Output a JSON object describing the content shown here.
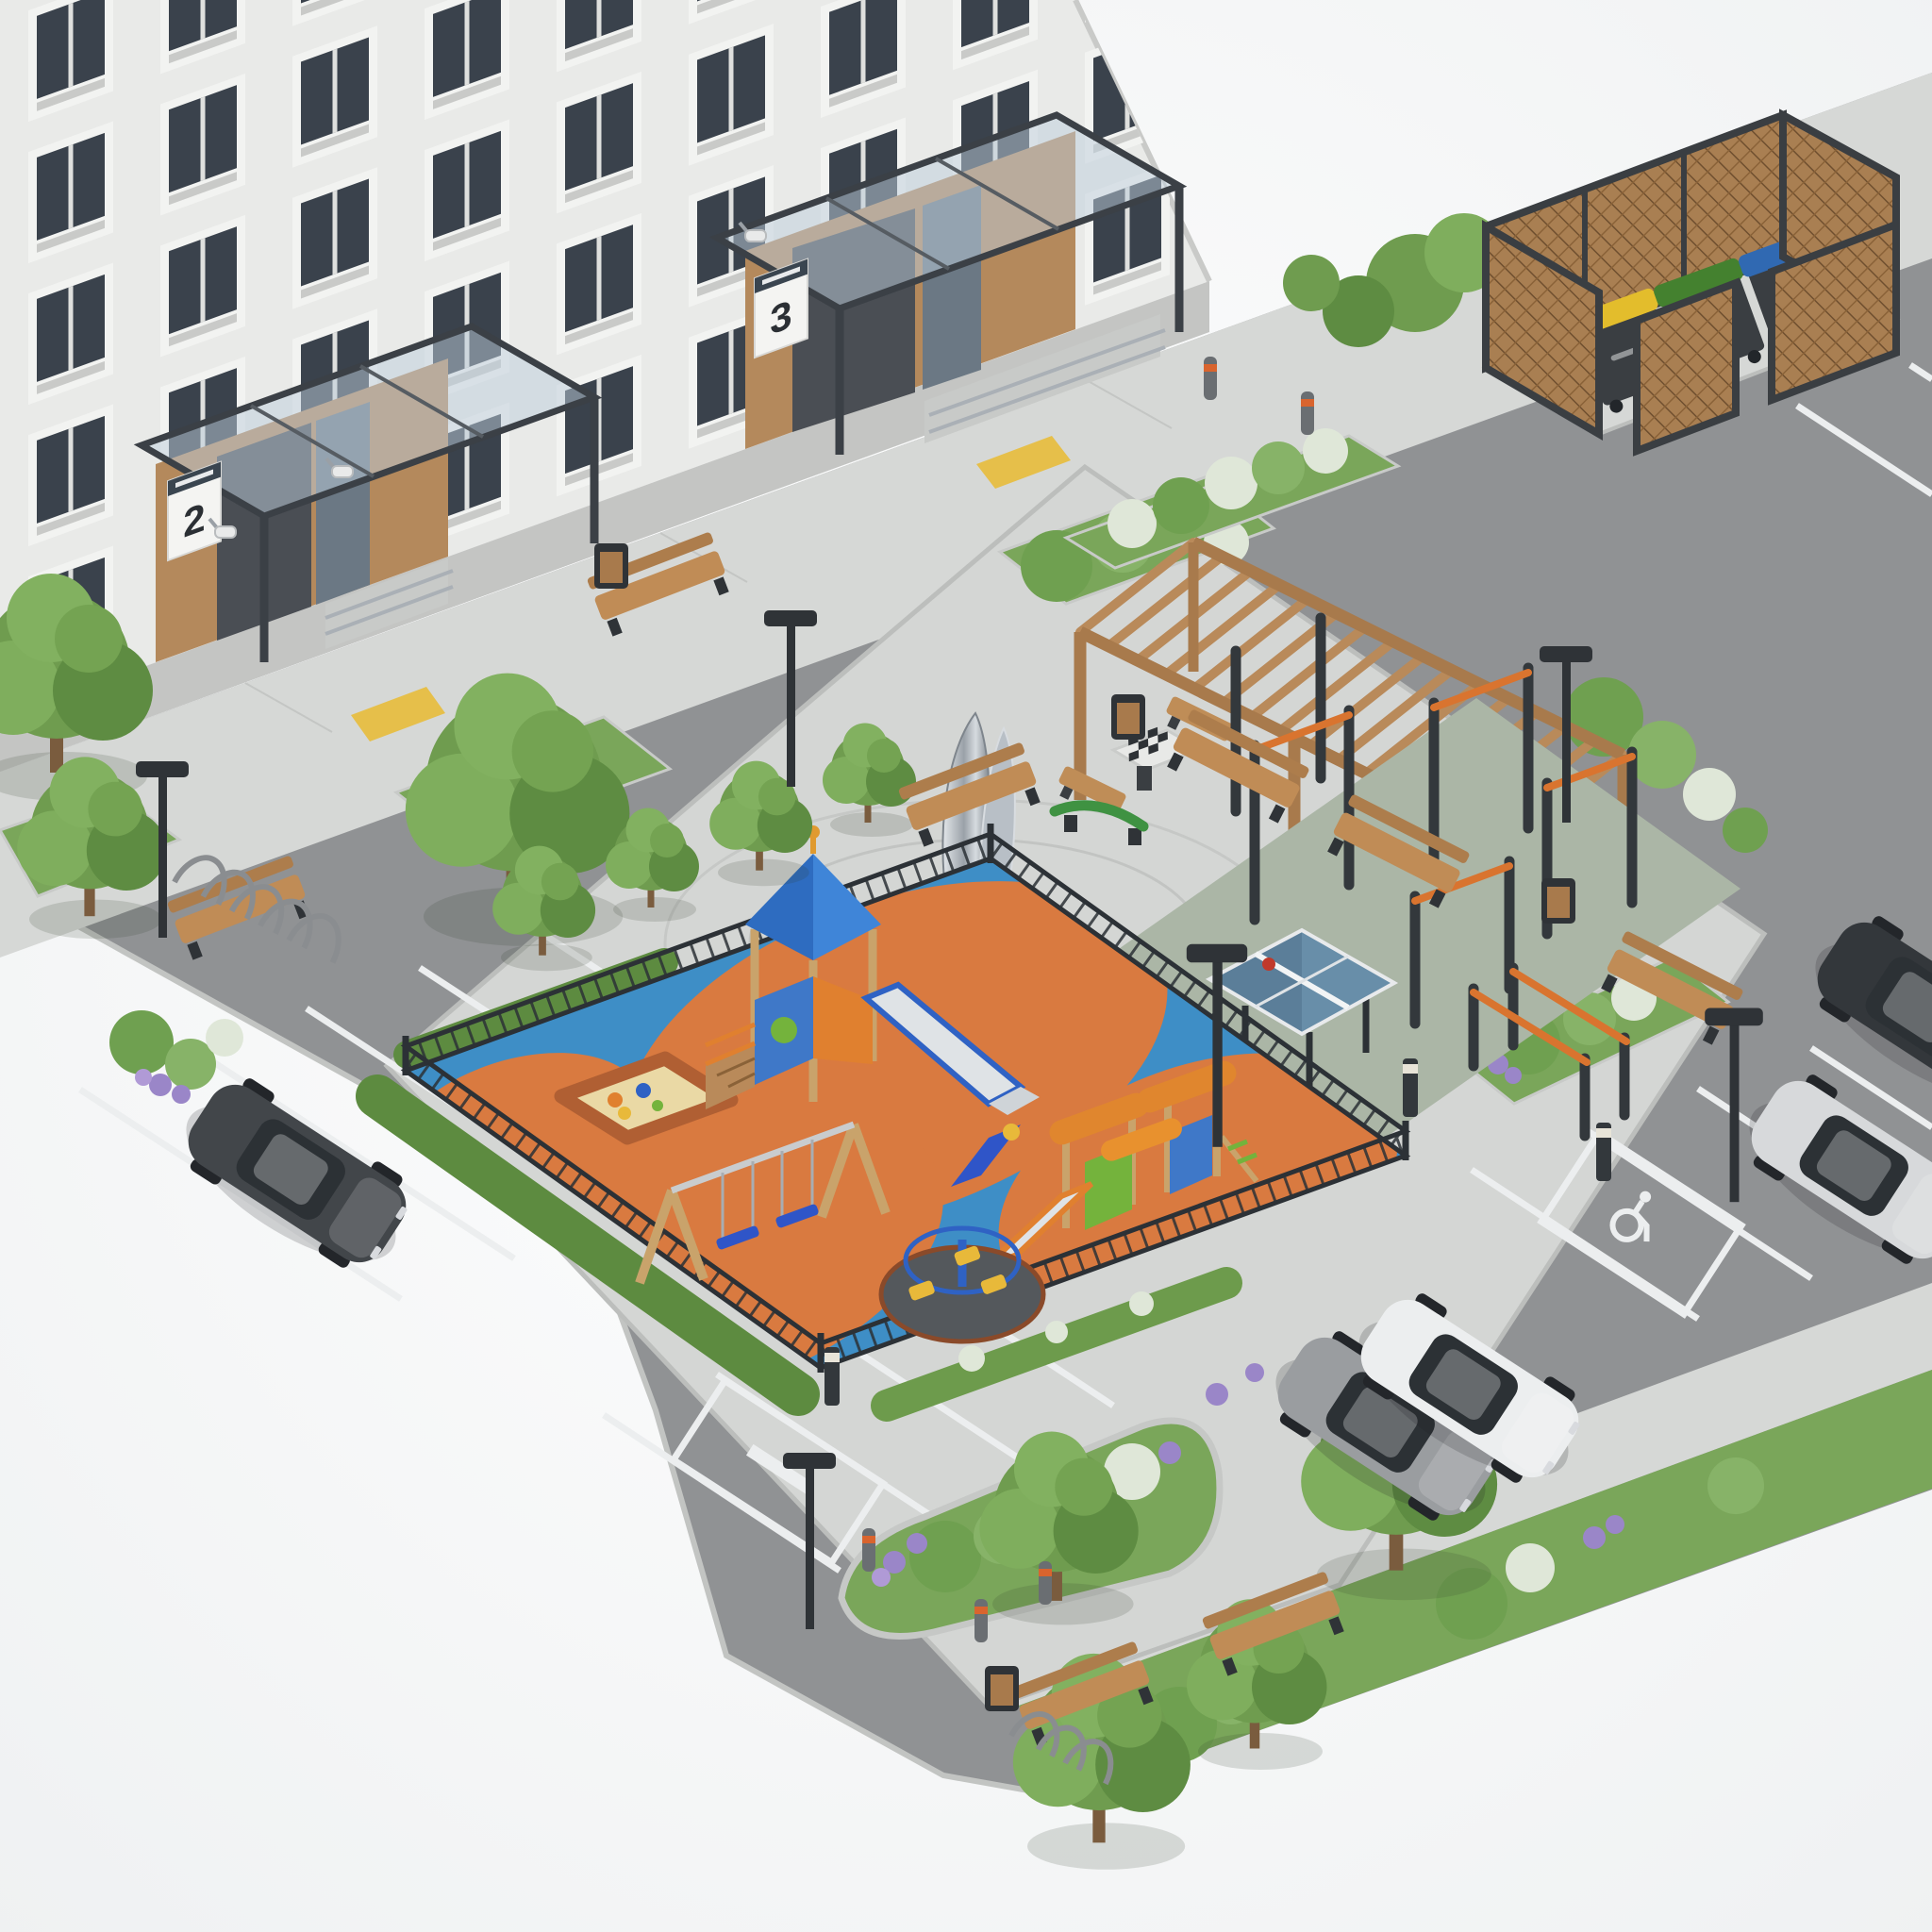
{
  "scene": {
    "title": "Residential courtyard landscaping – isometric 3D visualization",
    "background": "#f6f7f8",
    "style": "photorealistic architectural render"
  },
  "building": {
    "label": "panel apartment building",
    "facade_color": "#e9eae8",
    "plinth_color": "#c4c5c3",
    "window_glass": "#3a424c",
    "window_frame": "#f2f3f1",
    "entrances": [
      {
        "label": "entrance porch No.2",
        "sign_number": "2"
      },
      {
        "label": "entrance porch No.3",
        "sign_number": "3"
      }
    ],
    "features": [
      "glass entrance canopies",
      "CCTV cameras",
      "access ramps with railings",
      "yellow tactile paving"
    ]
  },
  "landscape": {
    "sidewalk": "#d6d8d6",
    "plaza_paving": "#d4d6d4",
    "lawn": "#7aa65a",
    "tree_green": "#6f9c4f",
    "hedge": "#5d8b40",
    "flowers": [
      "lavender",
      "white flowering shrubs"
    ]
  },
  "playground": {
    "label": "fenced children playground",
    "surface_blue": "#3e8ec6",
    "surface_orange": "#d97a40",
    "fence_color": "#2c3136",
    "equipment": [
      "play tower with pitched roof and slide",
      "toddler play unit with slide",
      "double swing set",
      "merry-go-round carousel",
      "sandbox with toys"
    ]
  },
  "sports_area": {
    "label": "workout and games area",
    "surface_color": "#abb6a6",
    "bar_accent": "#d9742f",
    "post_color": "#33383c",
    "table_color": "#5b7e99",
    "equipment": [
      "calisthenics pull-up bars",
      "parallel bars",
      "table tennis table"
    ]
  },
  "leisure_area": {
    "label": "quiet rest area",
    "wood_color": "#b98a5a",
    "items": [
      "wooden pergola",
      "benches with backrest",
      "chess table with benches",
      "green spring balance beam",
      "polished steel sculpture"
    ]
  },
  "waste_area": {
    "label": "waste collection point",
    "screen": "wooden lattice enclosure",
    "bins": [
      {
        "label": "container with yellow lid",
        "lid_color": "#e3bd2c"
      },
      {
        "label": "container with green lid",
        "lid_color": "#44812f"
      },
      {
        "label": "container with blue lid",
        "lid_color": "#3069b2"
      }
    ]
  },
  "parking": {
    "label": "guest parking",
    "asphalt": "#909294",
    "line_color": "#eceeef",
    "markings": [
      "standard stalls",
      "accessible stall with wheelchair symbol",
      "reserved stall with painted text"
    ],
    "cars": [
      {
        "label": "dark gray hatchback",
        "color": "#42464a"
      },
      {
        "label": "gray sedan",
        "color": "#9a9da0"
      },
      {
        "label": "white sedan",
        "color": "#eceeef"
      },
      {
        "label": "silver sedan",
        "color": "#d7d9db"
      },
      {
        "label": "black car",
        "color": "#33373b"
      }
    ]
  },
  "street_furniture": {
    "items": [
      "wood benches",
      "litter bins",
      "bicycle rack",
      "street lamps",
      "light bollards",
      "steel bollards with orange band"
    ]
  }
}
